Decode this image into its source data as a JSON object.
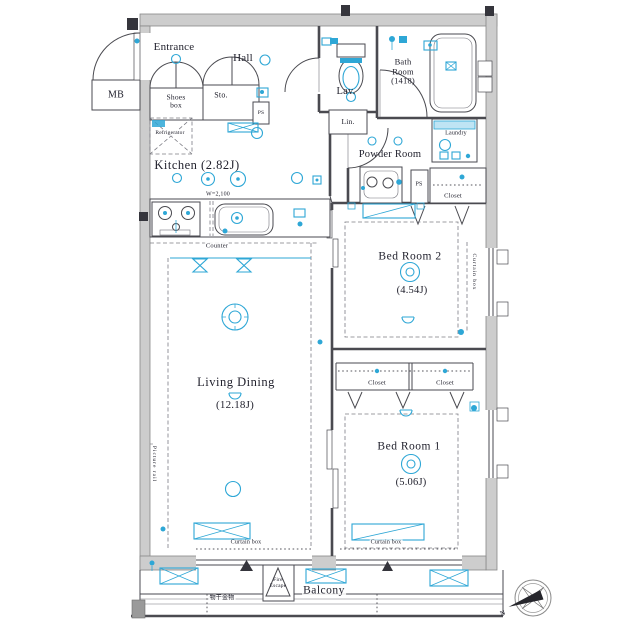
{
  "colors": {
    "accent_cyan": "#2ea7d6",
    "wall_gray": "#cdcdcd",
    "line_dark": "#4a4a50",
    "text": "#22222e"
  },
  "rooms": {
    "entrance": {
      "label": "Entrance"
    },
    "hall": {
      "label": "Hall"
    },
    "meter_box": {
      "label": "MB"
    },
    "shoes_box": {
      "label": "Shoes\nbox"
    },
    "storage": {
      "label": "Sto."
    },
    "lavatory": {
      "label": "Lav."
    },
    "bath": {
      "label": "Bath\nRoom\n(1418)"
    },
    "linen": {
      "label": "Lin."
    },
    "kitchen": {
      "label": "Kitchen (2.82J)"
    },
    "powder_room": {
      "label": "Powder Room"
    },
    "laundry": {
      "label": "Laundry"
    },
    "bedroom2": {
      "label": "Bed Room 2",
      "size": "(4.54J)"
    },
    "living_dining": {
      "label": "Living Dining",
      "size": "(12.18J)"
    },
    "bedroom1": {
      "label": "Bed Room 1",
      "size": "(5.06J)"
    },
    "balcony": {
      "label": "Balcony"
    }
  },
  "fixtures": {
    "refrigerator": "Refrigerator",
    "counter": "Counter",
    "counter_width": "W=2,100",
    "pipe_space_hall": "PS",
    "pipe_space_powder": "PS",
    "closet_top": "Closet",
    "closet_left": "Closet",
    "closet_right": "Closet",
    "curtain_box_right": "Curtain box",
    "curtain_box_living": "Curtain box",
    "curtain_box_bed1": "Curtain box",
    "picture_rail": "Picture rail",
    "fire_escape": "Fire\nEscape",
    "laundry_pole": "物干金物",
    "compass_north": "N"
  }
}
